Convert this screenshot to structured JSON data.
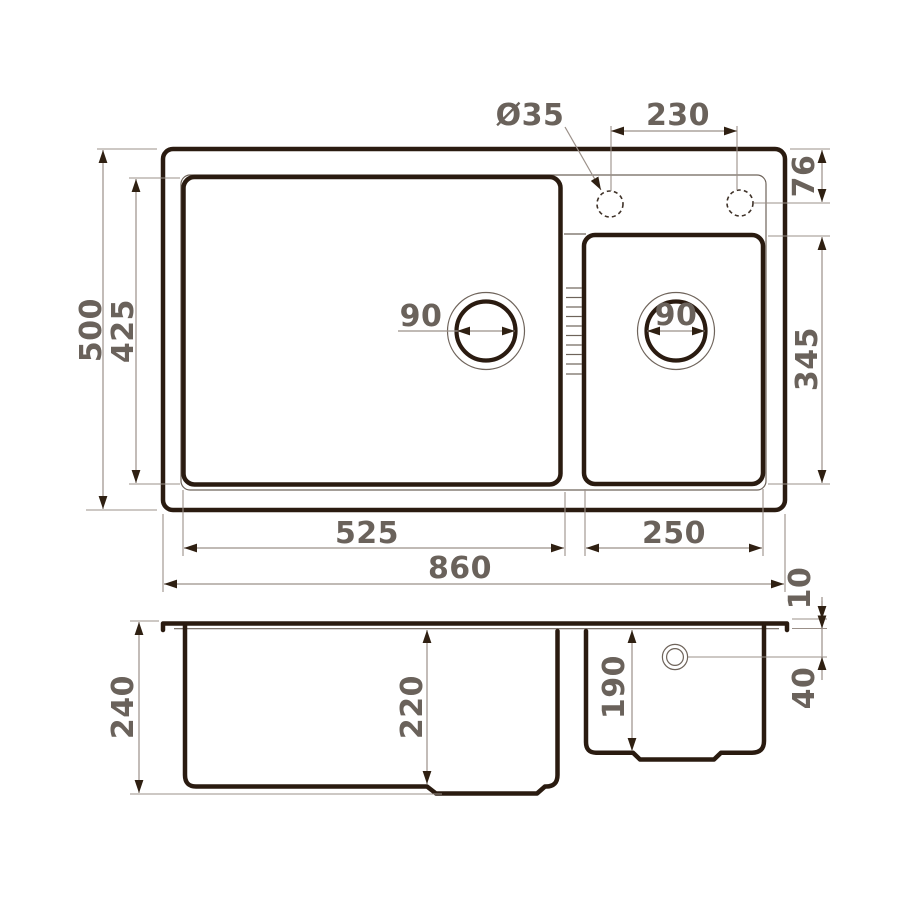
{
  "drawing": {
    "type": "sink-technical-drawing",
    "views": [
      "top-plan-view",
      "front-section-view"
    ],
    "line_color": "#2a1b10",
    "dimension_line_color": "#9b9089",
    "label_color": "#6a625b",
    "background_color": "#ffffff"
  },
  "top_view": {
    "labels": {
      "faucet_hole_diameter": "Ø35",
      "hole_spacing": "230",
      "hole_edge_offset": "76",
      "small_bowl_length": "345",
      "main_drain_diameter": "90",
      "small_drain_diameter": "90",
      "overall_depth": "500",
      "bowl_depth": "425",
      "main_bowl_width": "525",
      "small_bowl_width": "250",
      "overall_width": "860"
    }
  },
  "side_view": {
    "labels": {
      "overall_height": "240",
      "main_bowl_depth": "220",
      "small_bowl_depth": "190",
      "rim_thickness": "10",
      "drain_center_offset": "40"
    }
  }
}
